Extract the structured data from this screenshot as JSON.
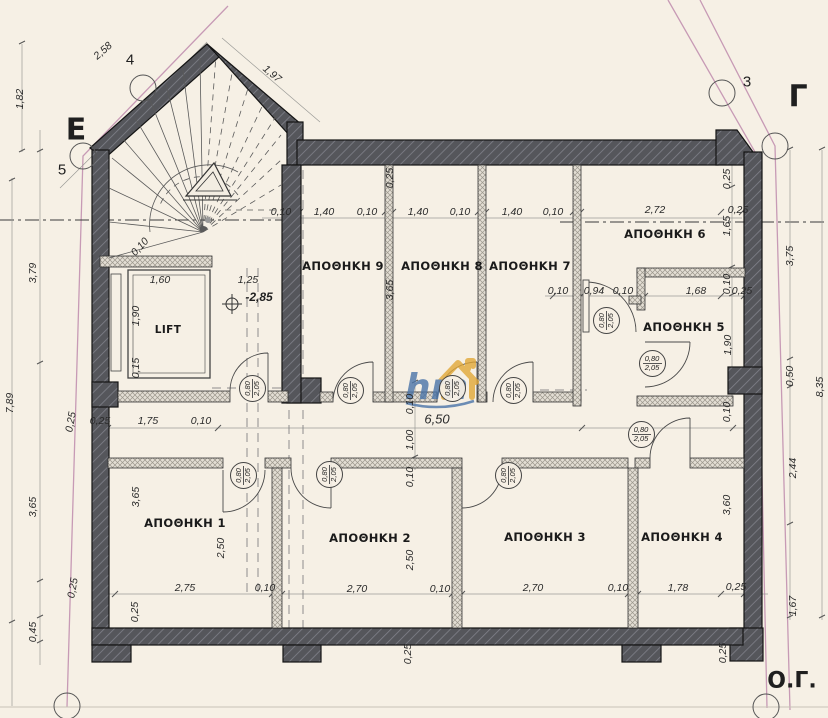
{
  "palette": {
    "background": "#f6f0e5",
    "wall_dark": "#55565b",
    "wall_hatch": "#80818a",
    "partition_light": "#e3ded4",
    "partition_hatch": "#9b968c",
    "boundary_pink": "#c79ab5",
    "watermark_blue": "#4a74a8",
    "watermark_orange": "#e2a838"
  },
  "watermark": {
    "text": "hm"
  },
  "level_marker": {
    "t": "-2,85",
    "x": 259,
    "y": 297
  },
  "rooms": [
    {
      "label": "ΑΠΟΘΗΚΗ 9",
      "x": 343,
      "y": 266
    },
    {
      "label": "ΑΠΟΘΗΚΗ 8",
      "x": 442,
      "y": 266
    },
    {
      "label": "ΑΠΟΘΗΚΗ 7",
      "x": 530,
      "y": 266
    },
    {
      "label": "ΑΠΟΘΗΚΗ 6",
      "x": 665,
      "y": 234
    },
    {
      "label": "ΑΠΟΘΗΚΗ 5",
      "x": 684,
      "y": 327
    },
    {
      "label": "LIFT",
      "x": 168,
      "y": 330,
      "small": true
    },
    {
      "label": "ΑΠΟΘΗΚΗ 1",
      "x": 185,
      "y": 523
    },
    {
      "label": "ΑΠΟΘΗΚΗ 2",
      "x": 370,
      "y": 538
    },
    {
      "label": "ΑΠΟΘΗΚΗ 3",
      "x": 545,
      "y": 537
    },
    {
      "label": "ΑΠΟΘΗΚΗ 4",
      "x": 682,
      "y": 537
    }
  ],
  "markers": [
    {
      "t": "4",
      "x": 130,
      "y": 60,
      "cls": "num"
    },
    {
      "t": "5",
      "x": 62,
      "y": 170,
      "cls": "num"
    },
    {
      "t": "3",
      "x": 747,
      "y": 82,
      "cls": "num"
    },
    {
      "t": "Ε",
      "x": 76,
      "y": 130,
      "cls": "big"
    },
    {
      "t": "Γ",
      "x": 798,
      "y": 97,
      "cls": "big"
    },
    {
      "t": "Ο.Γ.",
      "x": 792,
      "y": 681,
      "cls": "og"
    }
  ],
  "door_tags": [
    {
      "top": "0,80",
      "bottom": "2,05",
      "x": 252,
      "y": 388,
      "rot": -90
    },
    {
      "top": "0,80",
      "bottom": "2,05",
      "x": 350,
      "y": 390,
      "rot": -90
    },
    {
      "top": "0,80",
      "bottom": "2,05",
      "x": 452,
      "y": 388,
      "rot": -90
    },
    {
      "top": "0,80",
      "bottom": "2,05",
      "x": 513,
      "y": 390,
      "rot": -90
    },
    {
      "top": "0,80",
      "bottom": "2,05",
      "x": 606,
      "y": 320,
      "rot": -90
    },
    {
      "top": "0,80",
      "bottom": "2,05",
      "x": 652,
      "y": 363,
      "rot": 0
    },
    {
      "top": "0,80",
      "bottom": "2,05",
      "x": 641,
      "y": 434,
      "rot": 0
    },
    {
      "top": "0,80",
      "bottom": "2,05",
      "x": 243,
      "y": 475,
      "rot": -90
    },
    {
      "top": "0,80",
      "bottom": "2,05",
      "x": 329,
      "y": 474,
      "rot": -90
    },
    {
      "top": "0,80",
      "bottom": "2,05",
      "x": 508,
      "y": 475,
      "rot": -90
    }
  ],
  "dims": [
    {
      "t": "2,58",
      "x": 103,
      "y": 51,
      "r": -41
    },
    {
      "t": "1,97",
      "x": 272,
      "y": 74,
      "r": 40
    },
    {
      "t": "1,82",
      "x": 20,
      "y": 99,
      "r": -90
    },
    {
      "t": "0,10",
      "x": 140,
      "y": 247,
      "r": -47
    },
    {
      "t": "0,10",
      "x": 281,
      "y": 212,
      "r": 0
    },
    {
      "t": "1,40",
      "x": 324,
      "y": 212,
      "r": 0
    },
    {
      "t": "0,10",
      "x": 367,
      "y": 212,
      "r": 0
    },
    {
      "t": "1,40",
      "x": 418,
      "y": 212,
      "r": 0
    },
    {
      "t": "0,10",
      "x": 460,
      "y": 212,
      "r": 0
    },
    {
      "t": "1,40",
      "x": 512,
      "y": 212,
      "r": 0
    },
    {
      "t": "0,10",
      "x": 553,
      "y": 212,
      "r": 0
    },
    {
      "t": "2,72",
      "x": 655,
      "y": 210,
      "r": 0
    },
    {
      "t": "0,25",
      "x": 738,
      "y": 210,
      "r": 0
    },
    {
      "t": "0,25",
      "x": 390,
      "y": 178,
      "r": -90
    },
    {
      "t": "3,65",
      "x": 390,
      "y": 290,
      "r": -90
    },
    {
      "t": "0,25",
      "x": 727,
      "y": 179,
      "r": -90
    },
    {
      "t": "1,65",
      "x": 727,
      "y": 226,
      "r": -90
    },
    {
      "t": "3,79",
      "x": 33,
      "y": 273,
      "r": -90
    },
    {
      "t": "7,89",
      "x": 10,
      "y": 403,
      "r": -90
    },
    {
      "t": "3,65",
      "x": 33,
      "y": 507,
      "r": -90
    },
    {
      "t": "0,45",
      "x": 33,
      "y": 632,
      "r": -90
    },
    {
      "t": "0,25",
      "x": 71,
      "y": 422,
      "r": -80
    },
    {
      "t": "0,25",
      "x": 73,
      "y": 588,
      "r": -80
    },
    {
      "t": "1,60",
      "x": 160,
      "y": 280,
      "r": 0
    },
    {
      "t": "1,25",
      "x": 248,
      "y": 280,
      "r": 0
    },
    {
      "t": "1,90",
      "x": 136,
      "y": 316,
      "r": -90
    },
    {
      "t": "0,15",
      "x": 136,
      "y": 368,
      "r": -90
    },
    {
      "t": "0,10",
      "x": 558,
      "y": 291,
      "r": 0
    },
    {
      "t": "0,94",
      "x": 594,
      "y": 291,
      "r": 0
    },
    {
      "t": "0,10",
      "x": 623,
      "y": 291,
      "r": 0
    },
    {
      "t": "1,68",
      "x": 696,
      "y": 291,
      "r": 0
    },
    {
      "t": "0,10",
      "x": 727,
      "y": 284,
      "r": -90
    },
    {
      "t": "0,25",
      "x": 742,
      "y": 291,
      "r": 0
    },
    {
      "t": "1,90",
      "x": 728,
      "y": 345,
      "r": -90
    },
    {
      "t": "3,75",
      "x": 790,
      "y": 256,
      "r": -90
    },
    {
      "t": "0,50",
      "x": 790,
      "y": 376,
      "r": -90
    },
    {
      "t": "8,35",
      "x": 820,
      "y": 387,
      "r": -90
    },
    {
      "t": "2,44",
      "x": 793,
      "y": 468,
      "r": -90
    },
    {
      "t": "1,67",
      "x": 793,
      "y": 606,
      "r": -90
    },
    {
      "t": "0,25",
      "x": 100,
      "y": 421,
      "r": 0
    },
    {
      "t": "1,75",
      "x": 148,
      "y": 421,
      "r": 0
    },
    {
      "t": "0,10",
      "x": 201,
      "y": 421,
      "r": 0
    },
    {
      "t": "6,50",
      "x": 437,
      "y": 419,
      "r": 0,
      "lg": true
    },
    {
      "t": "0,10",
      "x": 410,
      "y": 404,
      "r": -90
    },
    {
      "t": "1,00",
      "x": 410,
      "y": 440,
      "r": -90
    },
    {
      "t": "0,10",
      "x": 410,
      "y": 477,
      "r": -90
    },
    {
      "t": "3,65",
      "x": 136,
      "y": 497,
      "r": -90
    },
    {
      "t": "2,50",
      "x": 221,
      "y": 548,
      "r": -90
    },
    {
      "t": "2,50",
      "x": 410,
      "y": 560,
      "r": -90
    },
    {
      "t": "0,10",
      "x": 727,
      "y": 412,
      "r": -90
    },
    {
      "t": "3,60",
      "x": 727,
      "y": 505,
      "r": -90
    },
    {
      "t": "0,25",
      "x": 135,
      "y": 612,
      "r": -90
    },
    {
      "t": "2,75",
      "x": 185,
      "y": 588,
      "r": 0
    },
    {
      "t": "0,10",
      "x": 265,
      "y": 588,
      "r": 0
    },
    {
      "t": "2,70",
      "x": 357,
      "y": 589,
      "r": 0
    },
    {
      "t": "0,10",
      "x": 440,
      "y": 589,
      "r": 0
    },
    {
      "t": "2,70",
      "x": 533,
      "y": 588,
      "r": 0
    },
    {
      "t": "0,10",
      "x": 618,
      "y": 588,
      "r": 0
    },
    {
      "t": "1,78",
      "x": 678,
      "y": 588,
      "r": 0
    },
    {
      "t": "0,25",
      "x": 736,
      "y": 587,
      "r": 0
    },
    {
      "t": "0,25",
      "x": 408,
      "y": 654,
      "r": -90
    },
    {
      "t": "0,25",
      "x": 723,
      "y": 653,
      "r": -90
    }
  ]
}
